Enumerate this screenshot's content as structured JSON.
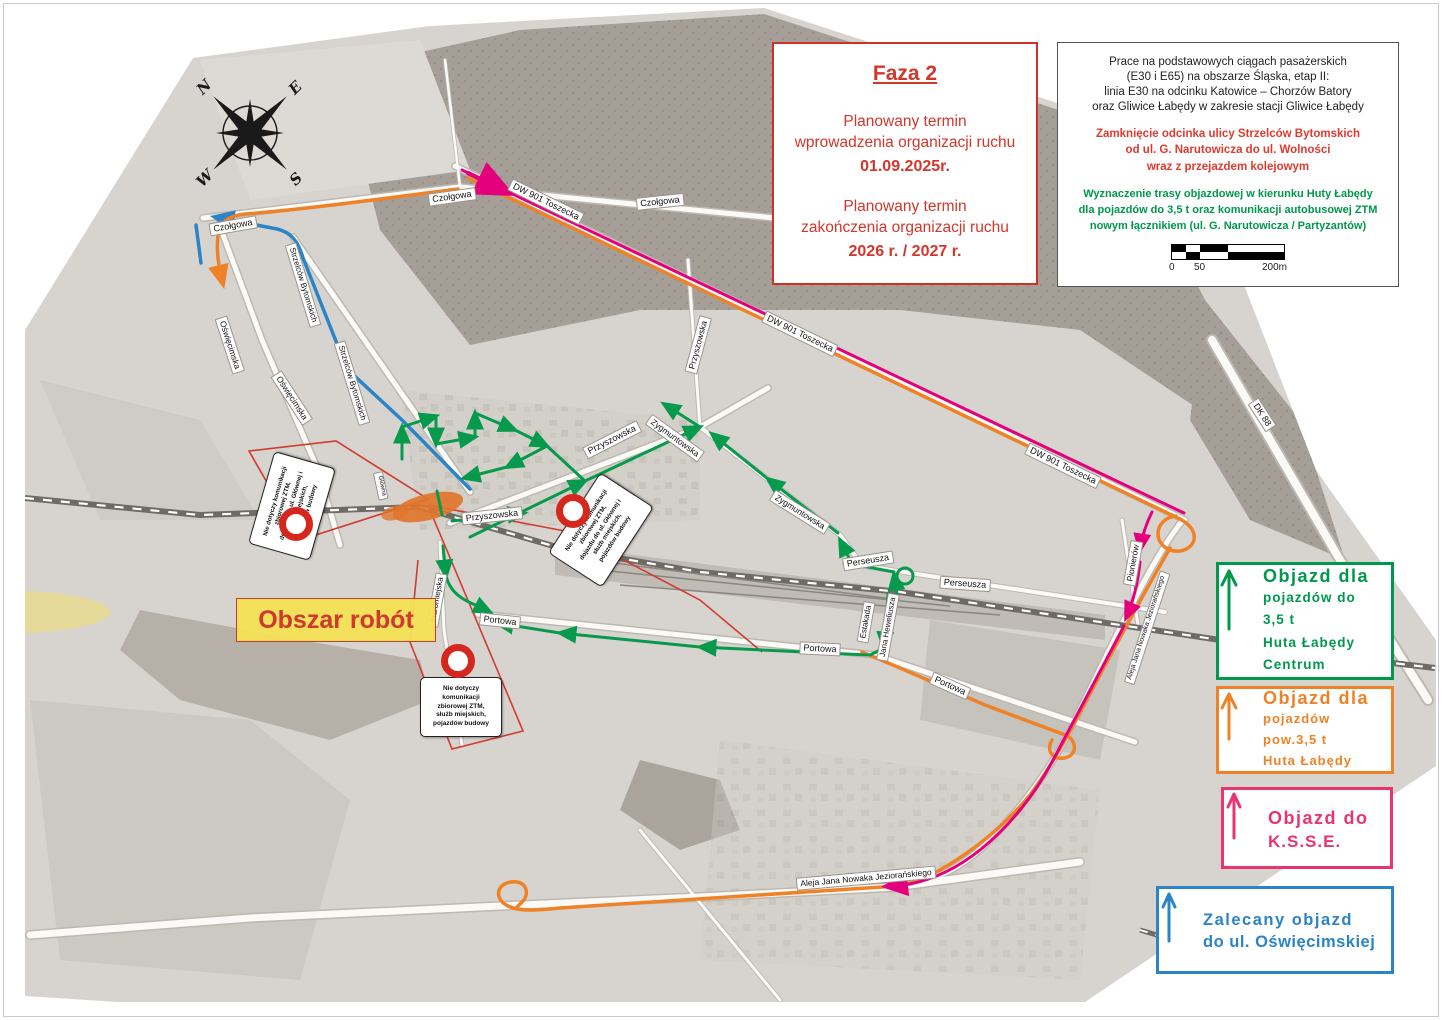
{
  "title": "Faza 2 – mapa organizacji ruchu Gliwice Łabędy",
  "colors": {
    "route_green": "#089a4c",
    "route_orange": "#ef8226",
    "route_magenta": "#e4007c",
    "route_blue": "#2a84c6",
    "legend_pink": "#e8356f",
    "alert_red": "#d3362b",
    "work_area_fill": "#df752c",
    "highlight_yellow": "#f4e054",
    "map_base": "#d7d4cf",
    "forest": "#a59f97"
  },
  "faza": {
    "title": "Faza 2",
    "intro1a": "Planowany termin",
    "intro1b": "wprowadzenia organizacji ruchu",
    "date1": "01.09.2025r.",
    "intro2a": "Planowany termin",
    "intro2b": "zakończenia organizacji ruchu",
    "date2": "2026 r. / 2027 r."
  },
  "info": {
    "p1": [
      "Prace na podstawowych ciągach pasażerskich",
      "(E30 i E65) na obszarze Śląska, etap II:",
      "linia E30 na odcinku Katowice – Chorzów Batory",
      "oraz Gliwice Łabędy w zakresie stacji Gliwice Łabędy"
    ],
    "p2": [
      "Zamknięcie odcinka ulicy Strzelców Bytomskich",
      "od ul. G. Narutowicza do ul. Wolności",
      "wraz z przejazdem kolejowym"
    ],
    "p3": [
      "Wyznaczenie trasy objazdowej w kierunku Huty Łabędy",
      "dla pojazdów do 3,5 t oraz komunikacji autobusowej ZTM",
      "nowym łącznikiem (ul. G. Narutowicza / Partyzantów)"
    ],
    "scale_labels": [
      "0",
      "50",
      "200m"
    ]
  },
  "legend": {
    "green": {
      "title": "Objazd dla",
      "lines": [
        "pojazdów do 3,5 t",
        "Huta Łabędy",
        "Centrum"
      ]
    },
    "orange": {
      "title": "Objazd dla",
      "lines": [
        "pojazdów pow.3,5 t",
        "Huta Łabędy"
      ]
    },
    "pink": {
      "title": "Objazd do",
      "lines": [
        "K.S.S.E."
      ]
    },
    "blue": {
      "title": "Zalecany objazd",
      "lines": [
        "do ul. Oświęcimskiej"
      ]
    }
  },
  "work_label": "Obszar robót",
  "compass": {
    "n": "N",
    "e": "E",
    "s": "S",
    "w": "W"
  },
  "callouts": [
    {
      "x": 292,
      "y": 506,
      "w": 94,
      "h": 62,
      "r": -74,
      "fs": 6.2,
      "lines": [
        "Nie dotyczy komunikacji",
        "zbiorowej ZTM,",
        "dojazdu do ul. Głównej i",
        "służb miejskich,",
        "pojazdów budowy"
      ]
    },
    {
      "x": 601,
      "y": 530,
      "w": 94,
      "h": 62,
      "r": -57,
      "fs": 6.2,
      "lines": [
        "Nie dotyczy komunikacji",
        "zbiorowej ZTM,",
        "dojazdu do ul. Głównej i",
        "służb miejskich,",
        "pojazdów budowy"
      ]
    },
    {
      "x": 461,
      "y": 707,
      "w": 80,
      "h": 58,
      "r": 0,
      "fs": 6.5,
      "lines": [
        "Nie dotyczy",
        "komunikacji",
        "zbiorowej ZTM,",
        "służb miejskich,",
        "pojazdów budowy"
      ]
    }
  ],
  "no_entry": [
    {
      "x": 296,
      "y": 524
    },
    {
      "x": 573,
      "y": 511
    },
    {
      "x": 458,
      "y": 661
    }
  ],
  "street_labels": [
    {
      "t": "Czołgowa",
      "x": 233,
      "y": 226,
      "r": -10,
      "s": 9
    },
    {
      "t": "Czołgowa",
      "x": 452,
      "y": 197,
      "r": -8,
      "s": 9
    },
    {
      "t": "Czołgowa",
      "x": 660,
      "y": 202,
      "r": -6,
      "s": 9
    },
    {
      "t": "Oświęcimska",
      "x": 230,
      "y": 345,
      "r": 72,
      "s": 8.5
    },
    {
      "t": "Oświęcimska",
      "x": 292,
      "y": 398,
      "r": 57,
      "s": 8.5
    },
    {
      "t": "Strzelców  Bytomskich",
      "x": 303,
      "y": 285,
      "r": 73,
      "s": 8
    },
    {
      "t": "Strzelców  Bytomskich",
      "x": 352,
      "y": 383,
      "r": 73,
      "s": 8
    },
    {
      "t": "DW 901  Toszecka",
      "x": 546,
      "y": 202,
      "r": 26,
      "s": 9
    },
    {
      "t": "DW 901  Toszecka",
      "x": 800,
      "y": 334,
      "r": 26,
      "s": 9
    },
    {
      "t": "DW 901  Toszecka",
      "x": 1063,
      "y": 466,
      "r": 26,
      "s": 9
    },
    {
      "t": "DK 88",
      "x": 1262,
      "y": 415,
      "r": 57,
      "s": 9
    },
    {
      "t": "Przyszowska",
      "x": 492,
      "y": 516,
      "r": -6,
      "s": 9
    },
    {
      "t": "Przyszowska",
      "x": 612,
      "y": 440,
      "r": -27,
      "s": 9
    },
    {
      "t": "Przyszowska",
      "x": 698,
      "y": 345,
      "r": -75,
      "s": 8.5
    },
    {
      "t": "Zygmuntowska",
      "x": 675,
      "y": 438,
      "r": 36,
      "s": 8.5
    },
    {
      "t": "Zygmuntowska",
      "x": 800,
      "y": 512,
      "r": 32,
      "s": 8.5
    },
    {
      "t": "Perseusza",
      "x": 868,
      "y": 561,
      "r": -9,
      "s": 9
    },
    {
      "t": "Perseusza",
      "x": 965,
      "y": 584,
      "r": 4,
      "s": 9
    },
    {
      "t": "Estakada",
      "x": 866,
      "y": 622,
      "r": -80,
      "s": 8
    },
    {
      "t": "Jana  Heweliusza",
      "x": 888,
      "y": 627,
      "r": -80,
      "s": 8
    },
    {
      "t": "Portowa",
      "x": 500,
      "y": 621,
      "r": 6,
      "s": 9
    },
    {
      "t": "Portowa",
      "x": 820,
      "y": 649,
      "r": 3,
      "s": 9
    },
    {
      "t": "Portowa",
      "x": 950,
      "y": 686,
      "r": 24,
      "s": 9
    },
    {
      "t": "Staromiejska",
      "x": 437,
      "y": 600,
      "r": -80,
      "s": 8
    },
    {
      "t": "Główna",
      "x": 381,
      "y": 486,
      "r": 78,
      "s": 6
    },
    {
      "t": "Pionierów",
      "x": 1133,
      "y": 563,
      "r": -80,
      "s": 8.5
    },
    {
      "t": "Aleja Jana Nowaka Jeziorańskiego",
      "x": 1147,
      "y": 628,
      "r": -72,
      "s": 7
    },
    {
      "t": "Aleja Jana Nowaka Jeziorańskiego",
      "x": 866,
      "y": 878,
      "r": -5,
      "s": 8.5
    }
  ]
}
